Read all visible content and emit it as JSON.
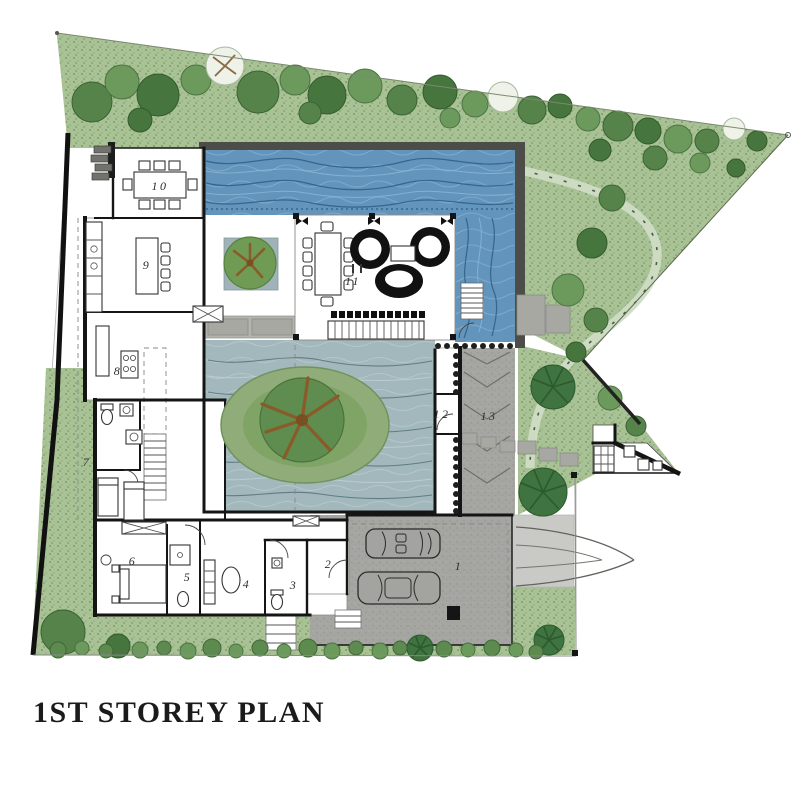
{
  "title": "1ST STOREY PLAN",
  "rooms": [
    {
      "id": 1,
      "label": "1"
    },
    {
      "id": 2,
      "label": "2"
    },
    {
      "id": 3,
      "label": "3"
    },
    {
      "id": 4,
      "label": "4"
    },
    {
      "id": 5,
      "label": "5"
    },
    {
      "id": 6,
      "label": "6"
    },
    {
      "id": 7,
      "label": "7"
    },
    {
      "id": 8,
      "label": "8"
    },
    {
      "id": 9,
      "label": "9"
    },
    {
      "id": 10,
      "label": "10"
    },
    {
      "id": 11,
      "label": "11"
    },
    {
      "id": 12,
      "label": "12"
    },
    {
      "id": 13,
      "label": "13"
    }
  ],
  "colors": {
    "pool_water": "#6394bc",
    "pond_water": "#a2b8bc",
    "garden_green": "#a9c295",
    "driveway_gray": "#a5a5a2",
    "deck_gray": "#a8a8a3",
    "wall_black": "#151515",
    "title_text": "#1b1b1b"
  }
}
